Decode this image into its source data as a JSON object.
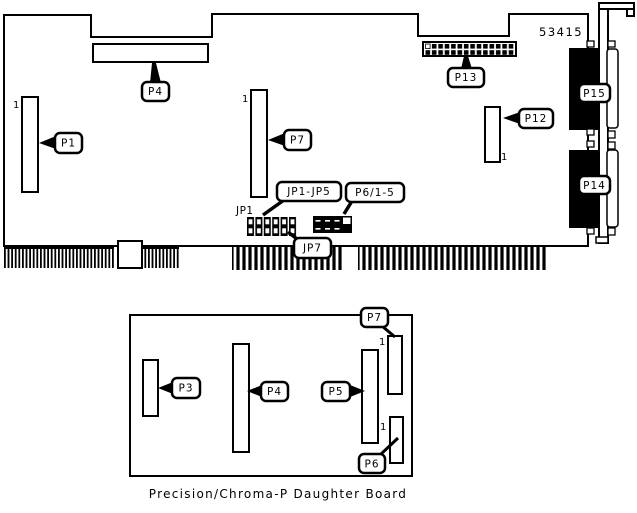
{
  "diagram": {
    "board_id": "53415",
    "pin1": "1",
    "main_board": {
      "jp1_silkscreen": "JP1",
      "callouts": {
        "p1": "P1",
        "p4": "P4",
        "p7": "P7",
        "p12": "P12",
        "p13": "P13",
        "p14": "P14",
        "p15": "P15",
        "jp1_jp5": "JP1-JP5",
        "p6_1_5": "P6/1-5",
        "jp7": "JP7"
      }
    },
    "daughter_board": {
      "caption": "Precision/Chroma-P Daughter Board",
      "callouts": {
        "p3": "P3",
        "p4": "P4",
        "p5": "P5",
        "p6": "P6",
        "p7": "P7"
      }
    }
  }
}
